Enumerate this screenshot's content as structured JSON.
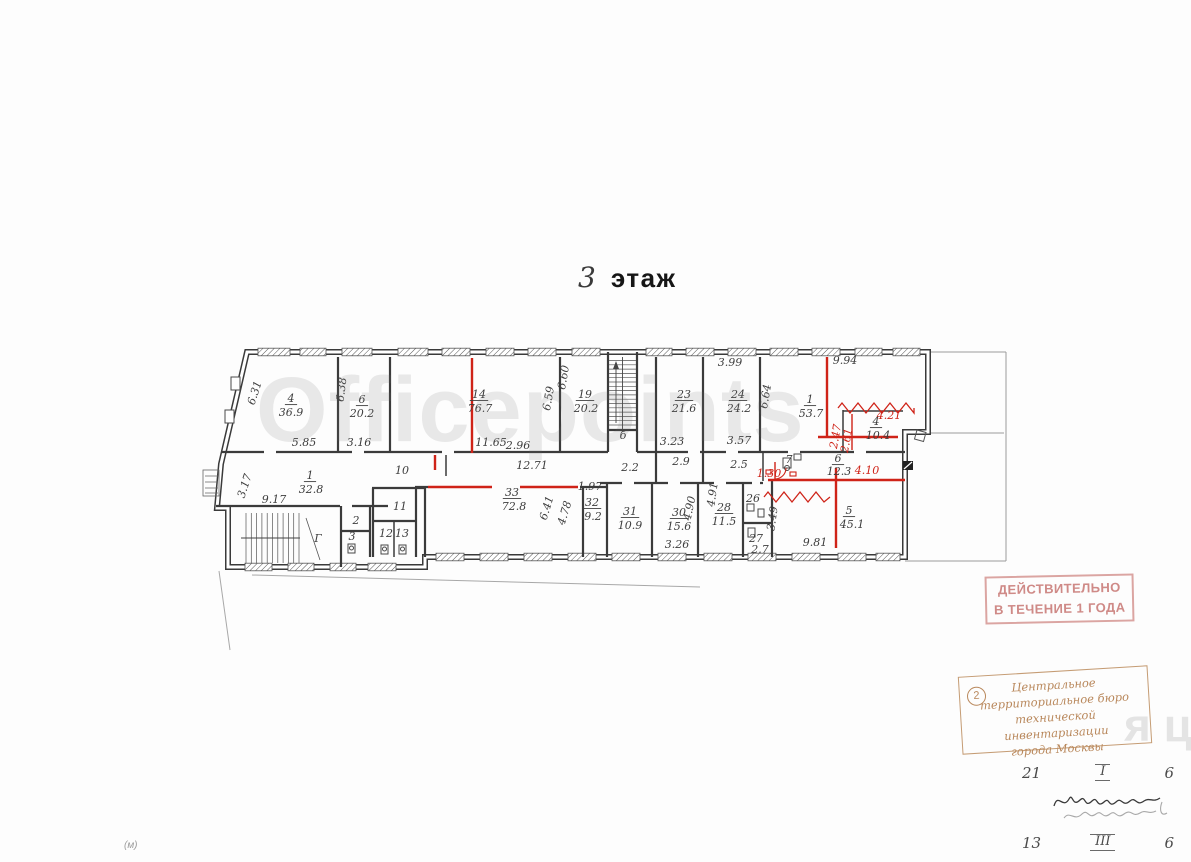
{
  "title": {
    "floor_number": "3",
    "floor_word": "этаж"
  },
  "watermark": {
    "main": "Officepoints",
    "secondary": "я цн"
  },
  "stamps": {
    "validity": {
      "line1": "ДЕЙСТВИТЕЛЬНО",
      "line2": "В ТЕЧЕНИЕ 1 ГОДА"
    },
    "bureau": {
      "number": "2",
      "line1": "Центральное",
      "line2": "территориальное бюро",
      "line3": "технической инвентаризации",
      "line4": "города Москвы"
    }
  },
  "notes": {
    "row1": [
      "21",
      "I",
      "6"
    ],
    "row2": [
      "13",
      "III",
      "6"
    ],
    "margin_mark": "(м)"
  },
  "plan": {
    "labels": [
      {
        "t": "4",
        "x": 291,
        "y": 402,
        "ul": 1,
        "k": "room-number-label"
      },
      {
        "t": "36.9",
        "x": 291,
        "y": 416,
        "k": "room-area-label"
      },
      {
        "t": "6",
        "x": 362,
        "y": 403,
        "ul": 1,
        "k": "room-number-label"
      },
      {
        "t": "20.2",
        "x": 362,
        "y": 417,
        "k": "room-area-label"
      },
      {
        "t": "14",
        "x": 479,
        "y": 398,
        "ul": 1,
        "k": "room-number-label"
      },
      {
        "t": "76.7",
        "x": 480,
        "y": 412,
        "k": "room-area-label"
      },
      {
        "t": "19",
        "x": 585,
        "y": 398,
        "ul": 1,
        "k": "room-number-label"
      },
      {
        "t": "20.2",
        "x": 586,
        "y": 412,
        "k": "room-area-label"
      },
      {
        "t": "23",
        "x": 684,
        "y": 398,
        "ul": 1,
        "k": "room-number-label"
      },
      {
        "t": "21.6",
        "x": 684,
        "y": 412,
        "k": "room-area-label"
      },
      {
        "t": "24",
        "x": 738,
        "y": 398,
        "ul": 1,
        "k": "room-number-label"
      },
      {
        "t": "24.2",
        "x": 739,
        "y": 412,
        "k": "room-area-label"
      },
      {
        "t": "1",
        "x": 810,
        "y": 403,
        "ul": 1,
        "k": "room-number-label"
      },
      {
        "t": "53.7",
        "x": 811,
        "y": 417,
        "k": "room-area-label"
      },
      {
        "t": "4",
        "x": 876,
        "y": 425,
        "ul": 1,
        "k": "room-number-label"
      },
      {
        "t": "10.4",
        "x": 878,
        "y": 439,
        "k": "room-area-label"
      },
      {
        "t": "1",
        "x": 310,
        "y": 479,
        "ul": 1,
        "k": "room-number-label"
      },
      {
        "t": "32.8",
        "x": 311,
        "y": 493,
        "k": "room-area-label"
      },
      {
        "t": "33",
        "x": 512,
        "y": 496,
        "ul": 1,
        "k": "room-number-label"
      },
      {
        "t": "72.8",
        "x": 514,
        "y": 510,
        "k": "room-area-label"
      },
      {
        "t": "32",
        "x": 592,
        "y": 506,
        "ul": 1,
        "k": "room-number-label"
      },
      {
        "t": "9.2",
        "x": 593,
        "y": 520,
        "k": "room-area-label"
      },
      {
        "t": "31",
        "x": 630,
        "y": 515,
        "ul": 1,
        "k": "room-number-label"
      },
      {
        "t": "10.9",
        "x": 630,
        "y": 529,
        "k": "room-area-label"
      },
      {
        "t": "30",
        "x": 679,
        "y": 516,
        "ul": 1,
        "k": "room-number-label"
      },
      {
        "t": "15.6",
        "x": 679,
        "y": 530,
        "k": "room-area-label"
      },
      {
        "t": "28",
        "x": 724,
        "y": 511,
        "ul": 1,
        "k": "room-number-label"
      },
      {
        "t": "11.5",
        "x": 724,
        "y": 525,
        "k": "room-area-label"
      },
      {
        "t": "5",
        "x": 849,
        "y": 514,
        "ul": 1,
        "k": "room-number-label"
      },
      {
        "t": "45.1",
        "x": 852,
        "y": 528,
        "k": "room-area-label"
      },
      {
        "t": "6",
        "x": 838,
        "y": 462,
        "ul": 1,
        "k": "room-number-label"
      },
      {
        "t": "12.3",
        "x": 839,
        "y": 475,
        "k": "room-area-label"
      },
      {
        "t": "2",
        "x": 356,
        "y": 524,
        "s": 10,
        "k": "room-number-label"
      },
      {
        "t": "3",
        "x": 352,
        "y": 540,
        "s": 10,
        "k": "room-number-label"
      },
      {
        "t": "11",
        "x": 400,
        "y": 510,
        "s": 10,
        "k": "room-number-label"
      },
      {
        "t": "12",
        "x": 386,
        "y": 537,
        "s": 9,
        "k": "room-number-label"
      },
      {
        "t": "13",
        "x": 402,
        "y": 537,
        "s": 9,
        "k": "room-number-label"
      },
      {
        "t": "26",
        "x": 753,
        "y": 502,
        "s": 10,
        "k": "room-number-label"
      },
      {
        "t": "27",
        "x": 756,
        "y": 542,
        "s": 10,
        "k": "room-number-label"
      },
      {
        "t": "7",
        "x": 789,
        "y": 463,
        "s": 9,
        "k": "room-number-label"
      },
      {
        "t": "10",
        "x": 402,
        "y": 474,
        "s": 9,
        "k": "corridor-width-label"
      },
      {
        "t": "б",
        "x": 623,
        "y": 439,
        "s": 13,
        "k": "staircase-label"
      },
      {
        "t": "Г",
        "x": 318,
        "y": 542,
        "s": 13,
        "k": "staircase-label"
      },
      {
        "t": "5.85",
        "x": 304,
        "y": 446,
        "s": 10
      },
      {
        "t": "3.16",
        "x": 359,
        "y": 446,
        "s": 10
      },
      {
        "t": "11.65",
        "x": 491,
        "y": 446,
        "s": 10
      },
      {
        "t": "2.96",
        "x": 518,
        "y": 449,
        "s": 10
      },
      {
        "t": "3.23",
        "x": 672,
        "y": 445,
        "s": 10
      },
      {
        "t": "3.57",
        "x": 739,
        "y": 444,
        "s": 10
      },
      {
        "t": "3.99",
        "x": 730,
        "y": 366,
        "s": 10
      },
      {
        "t": "9.94",
        "x": 845,
        "y": 364,
        "s": 10
      },
      {
        "t": "12.71",
        "x": 532,
        "y": 469,
        "s": 10
      },
      {
        "t": "1.97",
        "x": 590,
        "y": 490,
        "s": 10
      },
      {
        "t": "9.17",
        "x": 274,
        "y": 503,
        "s": 10
      },
      {
        "t": "3.26",
        "x": 677,
        "y": 548,
        "s": 10
      },
      {
        "t": "9.81",
        "x": 815,
        "y": 546,
        "s": 10
      },
      {
        "t": "2.2",
        "x": 630,
        "y": 471,
        "s": 10,
        "k": "corridor-width-label"
      },
      {
        "t": "2.9",
        "x": 681,
        "y": 465,
        "s": 10,
        "k": "corridor-width-label"
      },
      {
        "t": "2.5",
        "x": 739,
        "y": 468,
        "s": 10,
        "k": "corridor-width-label"
      },
      {
        "t": "2.7",
        "x": 760,
        "y": 553,
        "s": 9,
        "k": "corridor-width-label"
      },
      {
        "t": "6.31",
        "x": 258,
        "y": 394,
        "r": -72,
        "s": 10
      },
      {
        "t": "6.38",
        "x": 345,
        "y": 390,
        "r": -83,
        "s": 10
      },
      {
        "t": "6.59",
        "x": 552,
        "y": 399,
        "r": -80,
        "s": 10
      },
      {
        "t": "6.60",
        "x": 567,
        "y": 378,
        "r": -80,
        "s": 10
      },
      {
        "t": "6.64",
        "x": 769,
        "y": 397,
        "r": -80,
        "s": 10
      },
      {
        "t": "6.41",
        "x": 550,
        "y": 509,
        "r": -73,
        "s": 10
      },
      {
        "t": "4.78",
        "x": 568,
        "y": 514,
        "r": -73,
        "s": 10
      },
      {
        "t": "4.90",
        "x": 693,
        "y": 509,
        "r": -78,
        "s": 10
      },
      {
        "t": "4.91",
        "x": 716,
        "y": 495,
        "r": -82,
        "s": 10
      },
      {
        "t": "3.49",
        "x": 776,
        "y": 519,
        "r": -82,
        "s": 10
      },
      {
        "t": "3.17",
        "x": 248,
        "y": 487,
        "r": -72,
        "s": 10
      },
      {
        "t": "4.21",
        "x": 889,
        "y": 419,
        "s": 10,
        "c": "red"
      },
      {
        "t": "4.10",
        "x": 867,
        "y": 474,
        "s": 10,
        "c": "red"
      },
      {
        "t": "2.47",
        "x": 839,
        "y": 437,
        "r": -80,
        "s": 8,
        "c": "red"
      },
      {
        "t": "2.61",
        "x": 850,
        "y": 441,
        "r": -80,
        "s": 8,
        "c": "red"
      },
      {
        "t": "1.30",
        "x": 769,
        "y": 477,
        "s": 7,
        "c": "red"
      }
    ]
  }
}
